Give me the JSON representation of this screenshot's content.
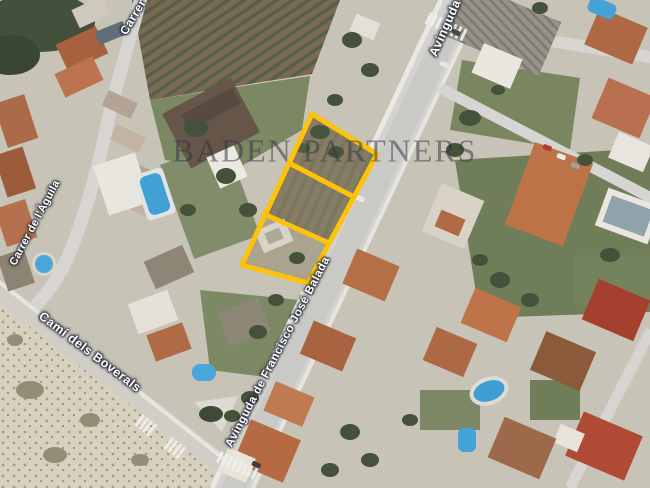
{
  "map": {
    "watermark_text": "BADEN PARTNERS",
    "street_labels": {
      "top_left": "Carrer",
      "left": "Carrer de l'Àguila",
      "bottom_left": "Camí dels Boverals",
      "main_avenue": "Avinguda de Francisco José Balada",
      "top_right": "Avinguda"
    },
    "highlighted_parcel": {
      "outline_color": "#FFC20A",
      "plot_count": "3",
      "outer_points": "312,114 377,154 308,283 242,265",
      "divider_1_points": "289,163 354,197",
      "divider_2_points": "264,214 329,243"
    }
  }
}
